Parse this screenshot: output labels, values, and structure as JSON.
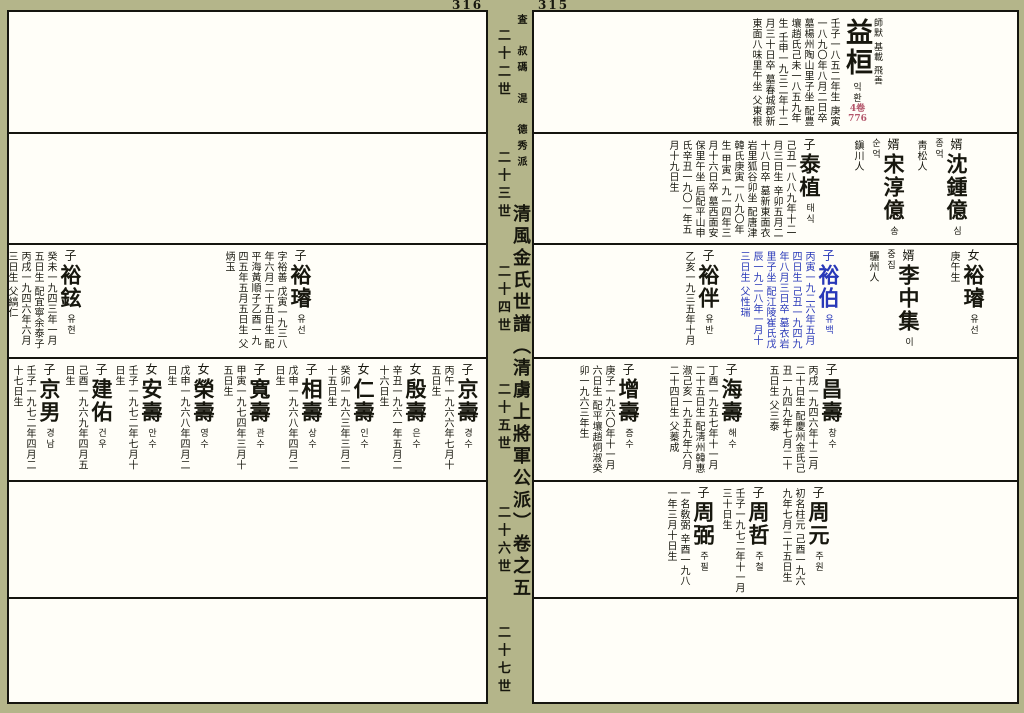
{
  "book": {
    "left_page_number": "316",
    "right_page_number": "315",
    "colors": {
      "background": "#b4b58a",
      "page": "#fffef8",
      "ink": "#17170e",
      "blue_entry": "#2838b8",
      "red_ref": "#b3566a"
    },
    "spine": {
      "branch_header": "査 叔碼 湜 德秀派",
      "title": "清風金氏世譜（清虜上將軍公派）卷之五",
      "generation_labels": [
        "二十二世",
        "二十三世",
        "二十四世",
        "二十五世",
        "二十六世",
        "二十七世"
      ]
    },
    "left_page": {
      "bands": [
        {
          "generation": "二十二世",
          "entries": []
        },
        {
          "generation": "二十三世",
          "entries": []
        },
        {
          "generation": "二十四世",
          "entries": [
            {
              "prefix": "子",
              "name": "裕璿",
              "hangul": "유선",
              "x": 175,
              "details": "字裕善 戊寅一九三八年六月二十五日生 配平海黃順子乙酉一九四五年五月五日生 父炳玉"
            },
            {
              "prefix": "子",
              "name": "裕鉉",
              "hangul": "유현",
              "x": 405,
              "details": "癸未一九四三年一月五日生 配宜寧余泰子丙戌一九四六年六月三日生 父縞仁"
            }
          ]
        },
        {
          "generation": "二十五世",
          "entries": [
            {
              "prefix": "子",
              "name": "京壽",
              "hangul": "경수",
              "x": 8,
              "details": "丙午一九六六年七月十五日生"
            },
            {
              "prefix": "女",
              "name": "殷壽",
              "hangul": "은수",
              "x": 60,
              "details": "辛丑一九六一年五月二十六日生"
            },
            {
              "prefix": "女",
              "name": "仁壽",
              "hangul": "인수",
              "x": 112,
              "details": "癸卯一九六三年三月二十五日生"
            },
            {
              "prefix": "子",
              "name": "相壽",
              "hangul": "상수",
              "x": 164,
              "details": "戊申一九六八年四月二日生"
            },
            {
              "prefix": "子",
              "name": "寬壽",
              "hangul": "관수",
              "x": 216,
              "details": "甲寅一九七四年三月十五日生"
            },
            {
              "prefix": "女",
              "name": "榮壽",
              "hangul": "영수",
              "x": 272,
              "details": "戊申一九六八年四月二日生"
            },
            {
              "prefix": "女",
              "name": "安壽",
              "hangul": "안수",
              "x": 324,
              "details": "壬子一九七二年七月十日生"
            },
            {
              "prefix": "子",
              "name": "建佑",
              "hangul": "건우",
              "x": 374,
              "details": "己酉一九六九年四月五日生"
            },
            {
              "prefix": "子",
              "name": "京男",
              "hangul": "경남",
              "x": 426,
              "details": "壬子一九七二年四月二十七日生"
            }
          ]
        },
        {
          "generation": "二十六世",
          "entries": []
        },
        {
          "generation": "二十七世",
          "entries": []
        }
      ]
    },
    "right_page": {
      "bands": [
        {
          "generation": "二十二世",
          "entries": [
            {
              "prefix": "",
              "name": "益桓",
              "hangul": "익환",
              "x": 135,
              "big": true,
              "note": "師默 基載 飛善",
              "ref_vol": "4卷",
              "ref_page": "776",
              "details": "壬子一八五二年生 庚寅一八九〇年八月二日卒 墓楊州陶山里子坐 配豊壤趙氏己未一八五九年生 壬申一九三二年十二月三十日卒 墓春城郡新東面八味里午坐 父東根"
            }
          ]
        },
        {
          "generation": "二十三世",
          "entries": [
            {
              "prefix": "婿",
              "name": "沈鍾億",
              "hangul": "심종억",
              "x": 50,
              "details": "靑松人"
            },
            {
              "prefix": "婿",
              "name": "宋淳億",
              "hangul": "송순억",
              "x": 113,
              "details": "鎭川人"
            },
            {
              "prefix": "子",
              "name": "泰植",
              "hangul": "태식",
              "x": 197,
              "details": "己丑一八八九年十二月三日生 辛卯五月二十八日卒 墓新東面衣岩里狐谷卯坐 配唐津韓氏庚寅一八九〇年生 甲寅一九一四年三月十六日卒 墓西面安保里午坐 后配平山申氏辛丑一九〇一年五月十九日生"
            }
          ]
        },
        {
          "generation": "二十四世",
          "entries": [
            {
              "prefix": "女",
              "name": "裕璿",
              "hangul": "유선",
              "x": 33,
              "details": "庚午生"
            },
            {
              "prefix": "婿",
              "name": "李中集",
              "hangul": "이중집",
              "x": 98,
              "details": "驪州人"
            },
            {
              "prefix": "子",
              "name": "裕伯",
              "hangul": "유백",
              "x": 178,
              "color": "blue",
              "details": "丙寅一九二六年五月四日生 己丑一九四九年八月三日卒 墓衣岩里子坐 配江陵崔氏戊辰一九二八年一月十三日生 父性瑞"
            },
            {
              "prefix": "子",
              "name": "裕伴",
              "hangul": "유반",
              "x": 298,
              "details": "乙亥一九三五年十月"
            }
          ]
        },
        {
          "generation": "二十五世",
          "entries": [
            {
              "prefix": "子",
              "name": "昌壽",
              "hangul": "창수",
              "x": 175,
              "details": "丙戌一九四六年十二月二十日生 配慶州金氏己丑一九四九年七月二十五日生 父三泰"
            },
            {
              "prefix": "子",
              "name": "海壽",
              "hangul": "해수",
              "x": 275,
              "details": "丁酉一九五七年十一月二十五日生 配淸州韓惠淑己亥一九五九年六月二十四日生 父蓁成"
            },
            {
              "prefix": "子",
              "name": "增壽",
              "hangul": "증수",
              "x": 378,
              "details": "庚子一九六〇年十一月六日生 配平壤趙炯淑癸卯一九六三年生"
            }
          ]
        },
        {
          "generation": "二十六世",
          "entries": [
            {
              "prefix": "子",
              "name": "周元",
              "hangul": "주원",
              "x": 188,
              "details": "初名柱元 己酉一九六九年七月二十五日生"
            },
            {
              "prefix": "子",
              "name": "周哲",
              "hangul": "주철",
              "x": 248,
              "details": "壬子一九七二年十一月三十日生"
            },
            {
              "prefix": "子",
              "name": "周弼",
              "hangul": "주필",
              "x": 303,
              "details": "一名敎弼 辛酉一九八一年三月十日生"
            }
          ]
        },
        {
          "generation": "二十七世",
          "entries": []
        }
      ]
    }
  }
}
